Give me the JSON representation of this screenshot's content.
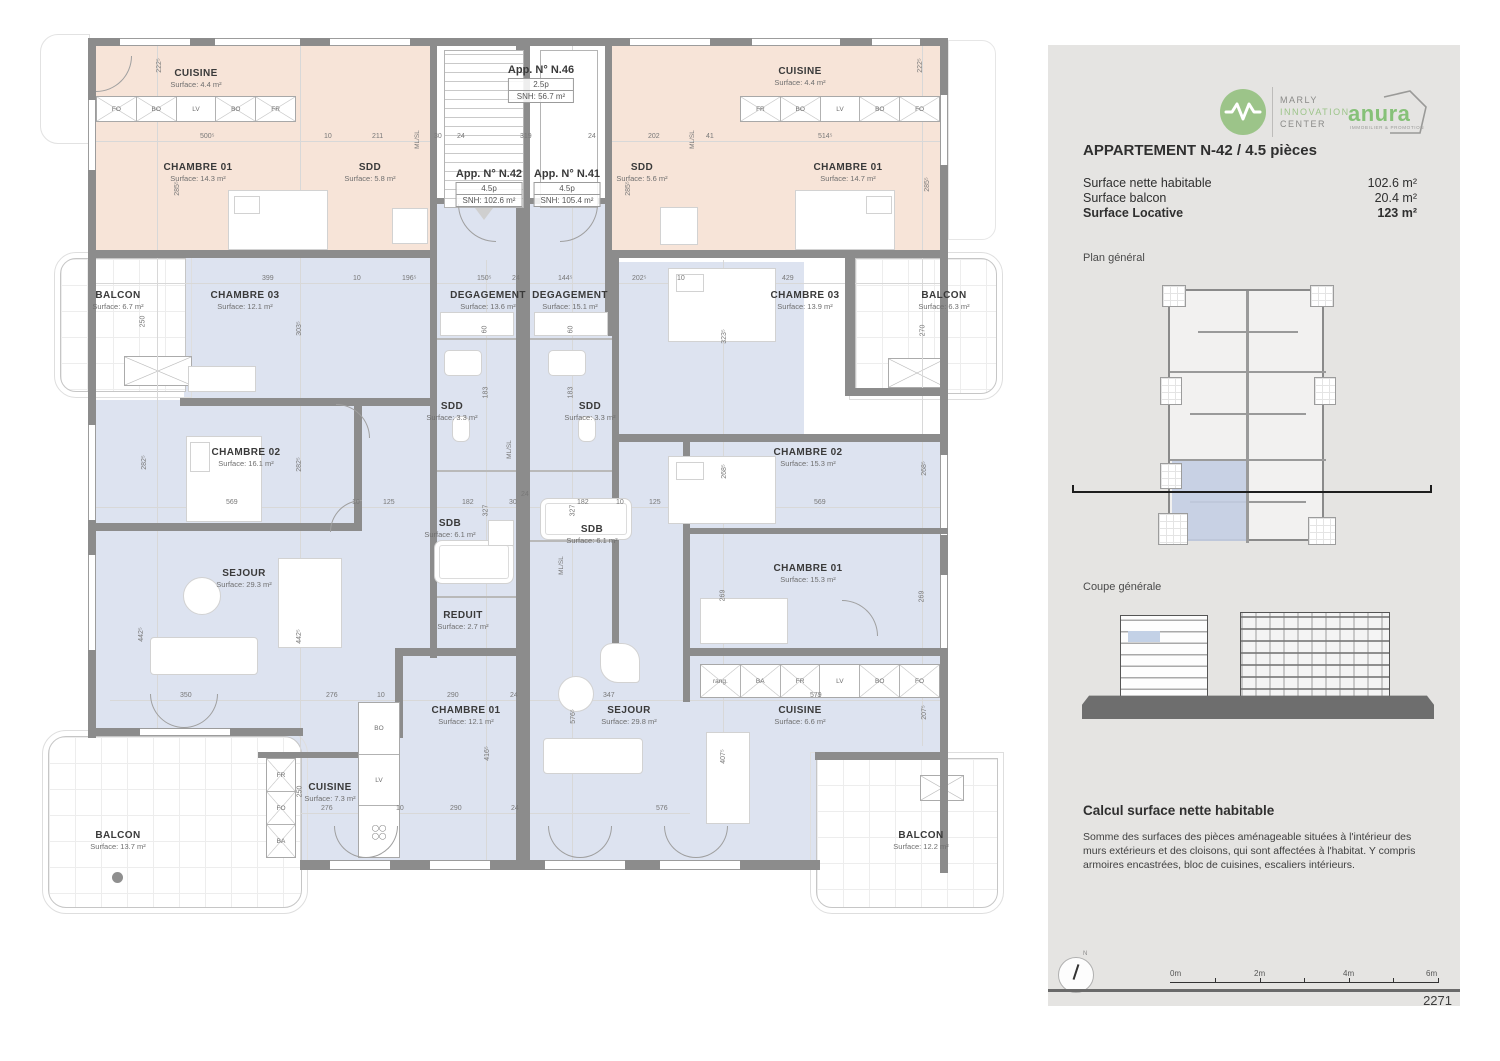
{
  "panel": {
    "logo_marly": {
      "line1": "MARLY",
      "line2": "INNOVATION",
      "line3": "CENTER",
      "green": "#9cc489"
    },
    "logo_anura": {
      "name": "anura",
      "tagline": "IMMOBILIER & PROMOTION",
      "green": "#86c178"
    },
    "title": "APPARTEMENT N-42 / 4.5 pièces",
    "surfaces": [
      {
        "label": "Surface nette habitable",
        "value": "102.6 m²"
      },
      {
        "label": "Surface balcon",
        "value": "20.4 m²"
      },
      {
        "label": "Surface Locative",
        "value": "123 m²"
      }
    ],
    "plan_general_label": "Plan général",
    "coupe_label": "Coupe générale",
    "calc_title": "Calcul surface nette habitable",
    "calc_text": "Somme des surfaces des pièces aménageable situées à l'intérieur des murs extérieurs et des cloisons, qui sont affectées à l'habitat. Y compris armoires encastrées, bloc de cuisines, escaliers intérieurs.",
    "compass_label": "N",
    "scale_labels": [
      "0m",
      "2m",
      "4m",
      "6m"
    ],
    "sheet_number": "2271"
  },
  "plan": {
    "tags": {
      "n46": {
        "title": "App. N° N.46",
        "p": "2.5p",
        "snh": "SNH: 56.7 m²"
      },
      "n42": {
        "title": "App. N° N.42",
        "p": "4.5p",
        "snh": "SNH: 102.6 m²"
      },
      "n41": {
        "title": "App. N° N.41",
        "p": "4.5p",
        "snh": "SNH: 105.4 m²"
      }
    },
    "rooms": {
      "pl_cuisine": {
        "name": "CUISINE",
        "surface": "Surface: 4.4 m²"
      },
      "pl_ch01": {
        "name": "CHAMBRE 01",
        "surface": "Surface: 14.3 m²"
      },
      "pl_sdd": {
        "name": "SDD",
        "surface": "Surface: 5.8 m²"
      },
      "pr_sdd": {
        "name": "SDD",
        "surface": "Surface: 5.6 m²"
      },
      "pr_cuisine": {
        "name": "CUISINE",
        "surface": "Surface: 4.4 m²"
      },
      "pr_ch01": {
        "name": "CHAMBRE 01",
        "surface": "Surface: 14.7 m²"
      },
      "n42_balcon_top": {
        "name": "BALCON",
        "surface": "Surface: 6.7 m²"
      },
      "n42_ch03": {
        "name": "CHAMBRE 03",
        "surface": "Surface: 12.1 m²"
      },
      "n42_deg": {
        "name": "DEGAGEMENT",
        "surface": "Surface: 13.6 m²"
      },
      "n41_deg": {
        "name": "DEGAGEMENT",
        "surface": "Surface: 15.1 m²"
      },
      "n41_ch03": {
        "name": "CHAMBRE 03",
        "surface": "Surface: 13.9 m²"
      },
      "n41_balcon": {
        "name": "BALCON",
        "surface": "Surface: 6.3 m²"
      },
      "n42_ch02": {
        "name": "CHAMBRE 02",
        "surface": "Surface: 16.1 m²"
      },
      "n42_sdd": {
        "name": "SDD",
        "surface": "Surface: 3.3 m²"
      },
      "n41_sdd": {
        "name": "SDD",
        "surface": "Surface: 3.3 m²"
      },
      "n41_ch02": {
        "name": "CHAMBRE 02",
        "surface": "Surface: 15.3 m²"
      },
      "n42_sdb": {
        "name": "SDB",
        "surface": "Surface: 6.1 m²"
      },
      "n41_sdb": {
        "name": "SDB",
        "surface": "Surface: 6.1 m²"
      },
      "n41_ch01": {
        "name": "CHAMBRE 01",
        "surface": "Surface: 15.3 m²"
      },
      "n42_sejour": {
        "name": "SEJOUR",
        "surface": "Surface: 29.3 m²"
      },
      "n42_reduit": {
        "name": "REDUIT",
        "surface": "Surface: 2.7 m²"
      },
      "n42_ch01": {
        "name": "CHAMBRE 01",
        "surface": "Surface: 12.1 m²"
      },
      "n41_sejour": {
        "name": "SEJOUR",
        "surface": "Surface: 29.8 m²"
      },
      "n41_cuisine": {
        "name": "CUISINE",
        "surface": "Surface: 6.6 m²"
      },
      "n42_cuisine": {
        "name": "CUISINE",
        "surface": "Surface: 7.3 m²"
      },
      "n42_balcon_bottom": {
        "name": "BALCON",
        "surface": "Surface: 13.7 m²"
      },
      "n41_balcon_bottom": {
        "name": "BALCON",
        "surface": "Surface: 12.2 m²"
      }
    },
    "kitchens": {
      "pl": [
        "FO",
        "BO",
        "LV",
        "BO",
        "FR"
      ],
      "pr": [
        "FR",
        "BO",
        "LV",
        "BO",
        "FO"
      ],
      "n41": [
        "rang.",
        "BA",
        "FR",
        "LV",
        "BO",
        "FO"
      ],
      "n42col": [
        "BO",
        "LV"
      ],
      "n42side": [
        "FR",
        "FO",
        "BA"
      ],
      "mlsl": "ML/SL"
    },
    "dims": {
      "d1": "222⁵",
      "d2": "500⁵",
      "d3": "10",
      "d4": "211",
      "d5": "30",
      "d6": "24",
      "d7": "319",
      "d8": "24",
      "d9": "202",
      "d10": "41",
      "d11": "514⁵",
      "d12": "222⁵",
      "d13": "285⁵",
      "d14": "285⁵",
      "d15": "285⁵",
      "d16": "399",
      "d17": "10",
      "d18": "196⁵",
      "d19": "150⁵",
      "d20": "24",
      "d21": "144⁵",
      "d22": "202⁵",
      "d23": "10",
      "d24": "429",
      "d25": "250",
      "d26": "303⁵",
      "d27": "60",
      "d28": "60",
      "d29": "323⁵",
      "d30": "270",
      "d31": "183",
      "d32": "183",
      "d33": "282⁵",
      "d34": "282⁵",
      "d35": "268⁵",
      "d36": "268⁵",
      "d37": "569",
      "d38": "10",
      "d39": "125",
      "d40": "182",
      "d41": "30",
      "d42": "24",
      "d43": "182",
      "d44": "10",
      "d45": "125",
      "d46": "569",
      "d47": "327",
      "d48": "327",
      "d49": "442⁵",
      "d50": "442⁵",
      "d51": "269",
      "d52": "269",
      "d53": "350",
      "d54": "276",
      "d55": "10",
      "d56": "290",
      "d57": "24",
      "d58": "347",
      "d59": "579",
      "d60": "576⁵",
      "d61": "207⁵",
      "d62": "416⁵",
      "d63": "407⁵",
      "d64": "276",
      "d65": "10",
      "d66": "290",
      "d67": "24",
      "d68": "576",
      "d69": "250"
    }
  }
}
